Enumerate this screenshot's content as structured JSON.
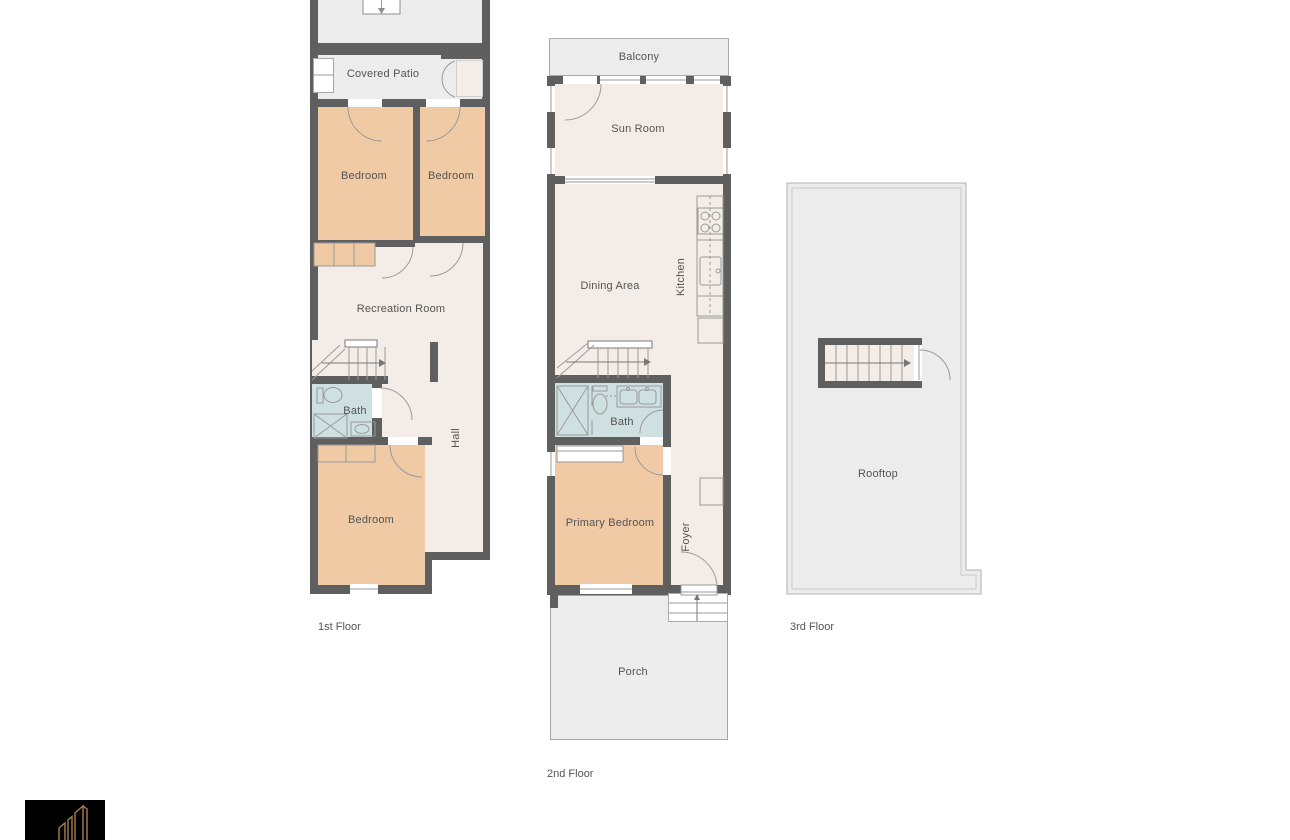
{
  "page": {
    "background": "#ffffff"
  },
  "colors": {
    "wall": "#5f5f5f",
    "floor_cream": "#f4ede7",
    "bedroom_peach": "#efcaa5",
    "bath_blue": "#cfe0e0",
    "outdoor_gray": "#ececec",
    "line_gray": "#9a9a9a",
    "text": "#545454",
    "logo_background": "#000000",
    "logo_gold": "#a87e4e"
  },
  "floors": {
    "first": {
      "label": "1st Floor",
      "rooms": {
        "patio": "Patio",
        "covered_patio": "Covered Patio",
        "bedroom_left": "Bedroom",
        "bedroom_right": "Bedroom",
        "recreation_room": "Recreation Room",
        "bath": "Bath",
        "hall": "Hall",
        "bedroom_lower": "Bedroom"
      }
    },
    "second": {
      "label": "2nd Floor",
      "rooms": {
        "balcony": "Balcony",
        "sun_room": "Sun Room",
        "dining_area": "Dining Area",
        "kitchen": "Kitchen",
        "bath": "Bath",
        "primary_bedroom": "Primary Bedroom",
        "foyer": "Foyer",
        "porch": "Porch"
      }
    },
    "third": {
      "label": "3rd Floor",
      "rooms": {
        "rooftop": "Rooftop"
      }
    }
  },
  "logo": {
    "name": "brand-logo"
  }
}
